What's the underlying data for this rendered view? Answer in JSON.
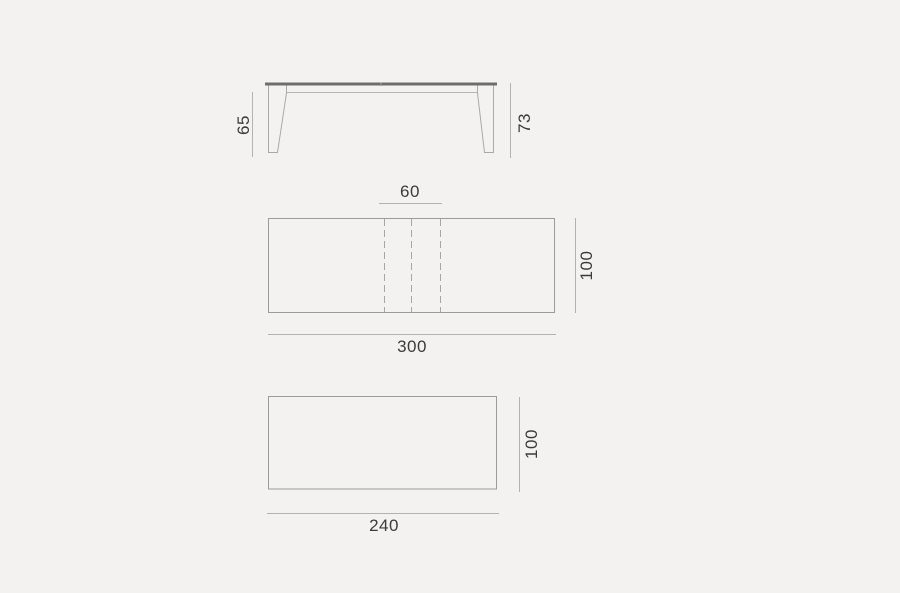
{
  "colors": {
    "background": "#f3f2f1",
    "outline": "#9b9b9b",
    "leg_outline": "#a9a9a9",
    "apron_line": "#b6b6b6",
    "fold_line": "#a6a6a6",
    "dim_line": "#b2b2b2",
    "tabletop": "#6d6d6d",
    "text": "#3b3b3b"
  },
  "views": {
    "side_elevation": {
      "leg_height": "65",
      "total_height": "73"
    },
    "top_view_extended": {
      "extension_width": "60",
      "depth": "100",
      "length": "300"
    },
    "top_view_closed": {
      "depth": "100",
      "length": "240"
    }
  }
}
